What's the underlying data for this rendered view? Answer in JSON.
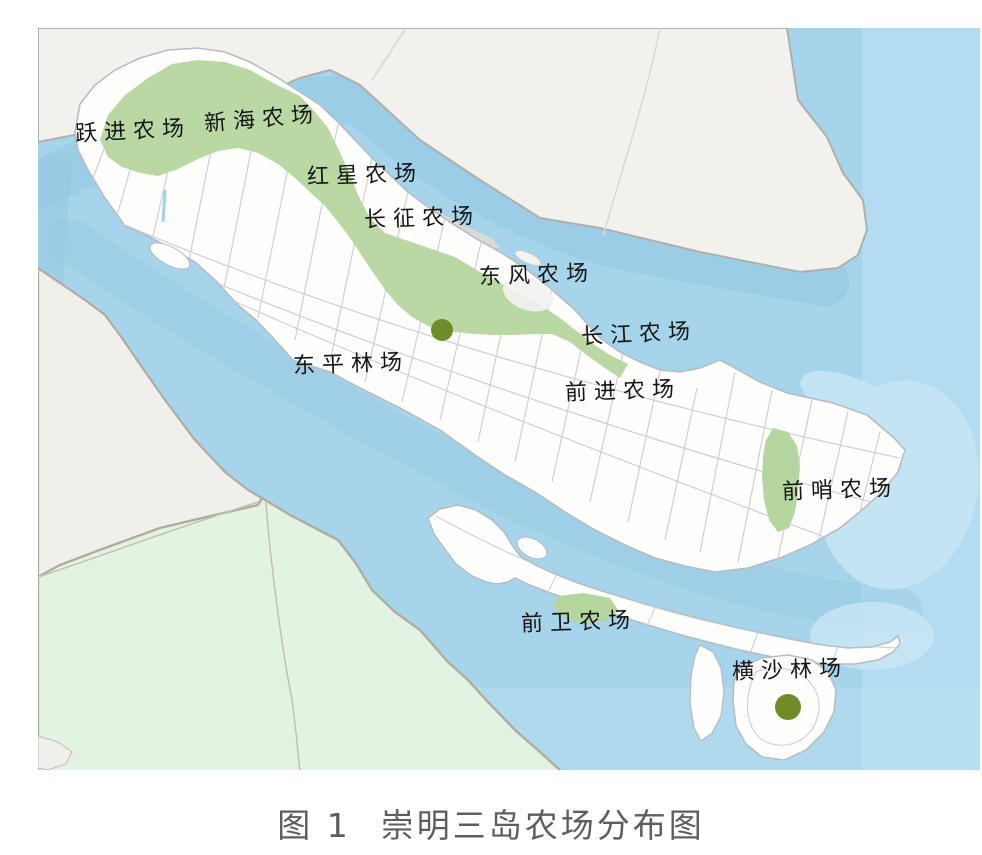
{
  "figure": {
    "type": "map",
    "region": "崇明三岛 (Chongming three islands), Yangtze estuary"
  },
  "caption": {
    "figure_label": "图 1",
    "title": "崇明三岛农场分布图",
    "color": "#5e5e5e"
  },
  "map": {
    "colors": {
      "water": "#a6d4ea",
      "open_sea_light": "#bfe4f5",
      "channel_deep": "#93c7e2",
      "shoal_fringe": "#c8e6f4",
      "island_fill": "#fefefd",
      "island_outline": "#b7bcc2",
      "farm_green": "#b6d69f",
      "north_mainland_gray": "#f2f1ee",
      "sw_mainland_green": "#e2f3e1",
      "sw_mainland_gray": "#f0efec",
      "coast_border": "#b2aca0",
      "road_line": "#c6cbd1",
      "sandbank_gray": "#dcdbd7",
      "forest_dot": "#6f8c28",
      "label_text": "#161616"
    },
    "labels": [
      {
        "id": "yuejin",
        "text": "跃进农场",
        "x": 133,
        "y": 130
      },
      {
        "id": "xinhai",
        "text": "新海农场",
        "x": 262,
        "y": 118
      },
      {
        "id": "hongxing",
        "text": "红星农场",
        "x": 365,
        "y": 174
      },
      {
        "id": "changzheng",
        "text": "长征农场",
        "x": 422,
        "y": 217
      },
      {
        "id": "dongfeng",
        "text": "东风农场",
        "x": 537,
        "y": 274
      },
      {
        "id": "changjiang",
        "text": "长江农场",
        "x": 639,
        "y": 333
      },
      {
        "id": "qianjin",
        "text": "前进农场",
        "x": 623,
        "y": 390
      },
      {
        "id": "dongping",
        "text": "东平林场",
        "x": 351,
        "y": 363
      },
      {
        "id": "qianshao",
        "text": "前哨农场",
        "x": 840,
        "y": 489
      },
      {
        "id": "qianwei",
        "text": "前卫农场",
        "x": 579,
        "y": 621
      },
      {
        "id": "hengsha",
        "text": "横沙林场",
        "x": 790,
        "y": 669
      }
    ],
    "markers": [
      {
        "name": "dongping-forest-dot",
        "x": 442,
        "y": 330,
        "r": 11
      },
      {
        "name": "hengsha-forest-dot",
        "x": 788,
        "y": 707,
        "r": 13
      }
    ]
  }
}
